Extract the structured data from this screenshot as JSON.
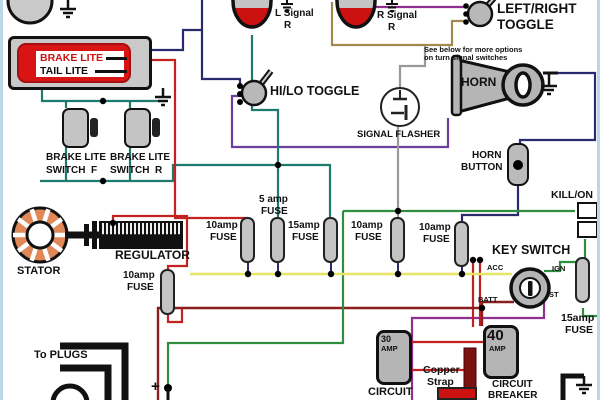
{
  "colors": {
    "red": "#c42222",
    "maroon": "#8b1f1f",
    "teal": "#1f7a6e",
    "green": "#2f8f3f",
    "yellow": "#e6e565",
    "purple": "#6a3f9e",
    "violet": "#8f2f8f",
    "navy": "#2a2a6e",
    "gray": "#999999",
    "tan": "#a08a50",
    "stator_orange": "#e08858",
    "component_gray": "#c4c4c4",
    "lamp_red": "#cc1111"
  },
  "labels": {
    "brake_lite": "BRAKE LITE",
    "tail_lite": "TAIL LITE",
    "l_signal_1": "L Signal",
    "l_signal_2": "R",
    "r_signal_1": "R Signal",
    "r_signal_2": "R",
    "hilo_toggle": "HI/LO TOGGLE",
    "lr_toggle_1": "LEFT/RIGHT",
    "lr_toggle_2": "TOGGLE",
    "lr_note_1": "See below for more options",
    "lr_note_2": "on turn signal switches",
    "horn": "HORN",
    "signal_flasher": "SIGNAL FLASHER",
    "horn_button_1": "HORN",
    "horn_button_2": "BUTTON",
    "kill_on": "KILL/ON",
    "key_switch": "KEY SWITCH",
    "acc": "ACC",
    "ign": "IGN",
    "batt": "BATT",
    "st": "ST",
    "brake_switch_f_1": "BRAKE LITE",
    "brake_switch_f_2": "SWITCH  F",
    "brake_switch_r_1": "BRAKE LITE",
    "brake_switch_r_2": "SWITCH  R",
    "stator": "STATOR",
    "regulator": "REGULATOR",
    "to_plugs": "To PLUGS",
    "plus": "+",
    "copper_1": "Copper",
    "copper_2": "Strap",
    "breaker30_a": "30",
    "breaker30_b": "AMP",
    "breaker30_label": "CIRCUIT",
    "breaker40_a": "40",
    "breaker40_b": "AMP",
    "breaker40_label_1": "CIRCUIT",
    "breaker40_label_2": "BREAKER"
  },
  "fuses": {
    "f1": {
      "l1": "10amp",
      "l2": "FUSE"
    },
    "f2": {
      "l1": "5 amp",
      "l2": "FUSE"
    },
    "f3": {
      "l1": "15amp",
      "l2": "FUSE"
    },
    "f4": {
      "l1": "10amp",
      "l2": "FUSE"
    },
    "f5": {
      "l1": "10amp",
      "l2": "FUSE"
    },
    "left": {
      "l1": "10amp",
      "l2": "FUSE"
    },
    "right": {
      "l1": "15amp",
      "l2": "FUSE"
    }
  }
}
